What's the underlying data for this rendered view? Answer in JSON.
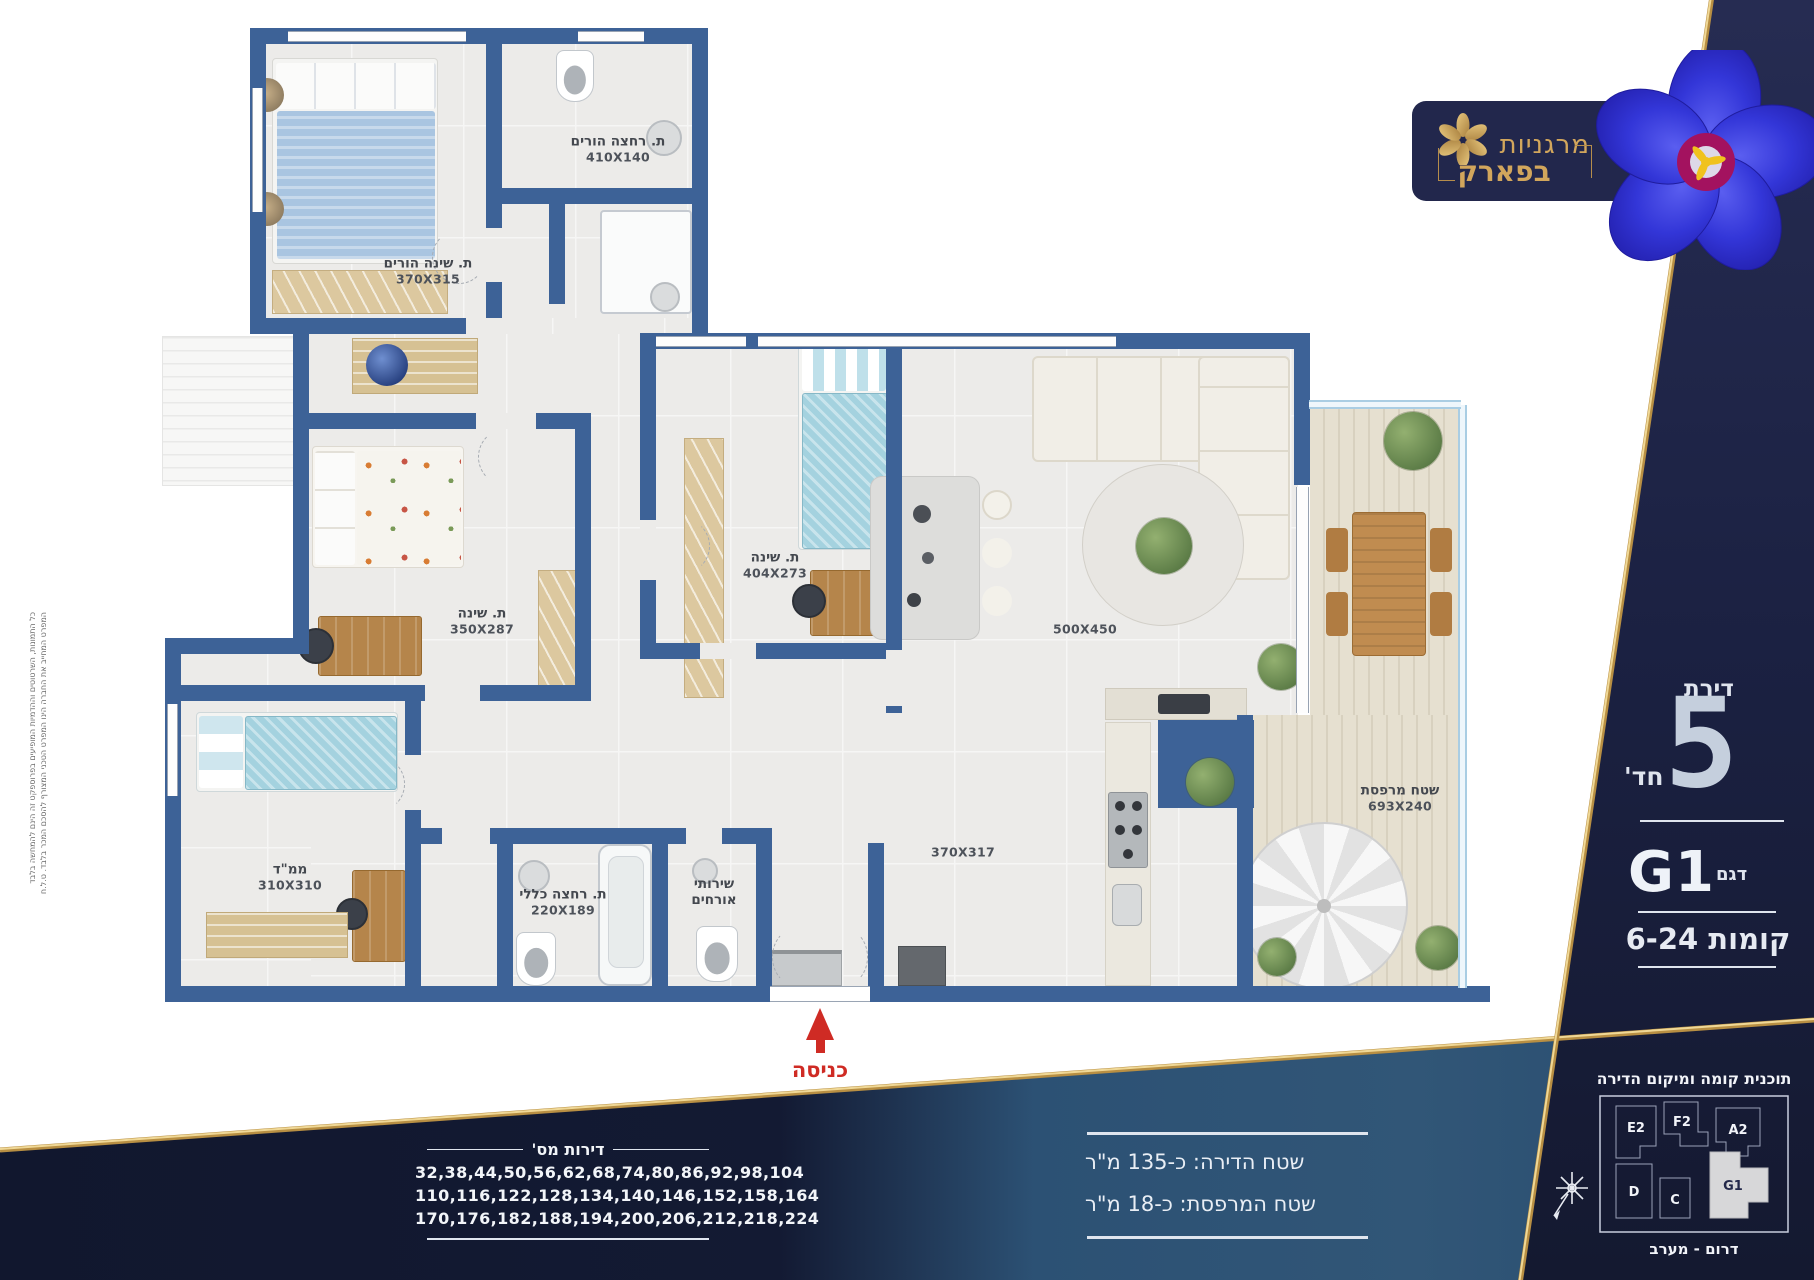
{
  "brand": {
    "name_line1": "מרגניות",
    "name_line2": "בפארק"
  },
  "panel": {
    "apartment_word": "דירת",
    "rooms_number": "5",
    "rooms_word": "חד'",
    "model": "G1",
    "model_word": "דגם",
    "floors": "קומות 6-24"
  },
  "location": {
    "title": "תוכנית קומה ומיקום הדירה",
    "orientation": "דרום - מערב",
    "units": [
      {
        "label": "E2"
      },
      {
        "label": "F2"
      },
      {
        "label": "A2"
      },
      {
        "label": "D"
      },
      {
        "label": "C"
      },
      {
        "label": "G1"
      }
    ],
    "highlighted_unit": "G1"
  },
  "areas": {
    "apartment": "שטח הדירה:  כ-135 מ\"ר",
    "balcony": "שטח המרפסת:  כ-18 מ\"ר"
  },
  "apartment_numbers": {
    "title": "דירות מס'",
    "rows": [
      "32,38,44,50,56,62,68,74,80,86,92,98,104",
      "110,116,122,128,134,140,146,152,158,164",
      "170,176,182,188,194,200,206,212,218,224"
    ]
  },
  "floor_plan": {
    "entry_label": "כניסה",
    "rooms": [
      {
        "name": "ת. שינה הורים",
        "dims": "370X315"
      },
      {
        "name": "ת. רחצה הורים",
        "dims": "410X140"
      },
      {
        "name": "ת. שינה",
        "dims": "404X273"
      },
      {
        "name": "ת. שינה",
        "dims": "350X287"
      },
      {
        "name": "ממ\"ד",
        "dims": "310X310"
      },
      {
        "name": "ת. רחצה כללי",
        "dims": "220X189"
      },
      {
        "name": "שירותי",
        "name2": "אורחים"
      },
      {
        "name": "שטח מרפסת",
        "dims": "693X240"
      },
      {
        "dims": "500X450"
      },
      {
        "dims": "370X317"
      }
    ]
  },
  "disclaimer": {
    "line1": "כל התמונות, השרטוטים וההדמיות המופיעים בפרוספקט זה הינם להמחשה בלבד",
    "line2": "המפרט המחייב את החברה הינו המפרט הטכני המצורף להסכם המכר בלבד. ט.ל.ח"
  },
  "colors": {
    "navy": "#1b2142",
    "gold": "#c9a254",
    "wall_blue": "#3d6297",
    "steel_blue": "#315677",
    "entry_red": "#cf2b24",
    "unit_highlight": "#d7d7d9"
  }
}
